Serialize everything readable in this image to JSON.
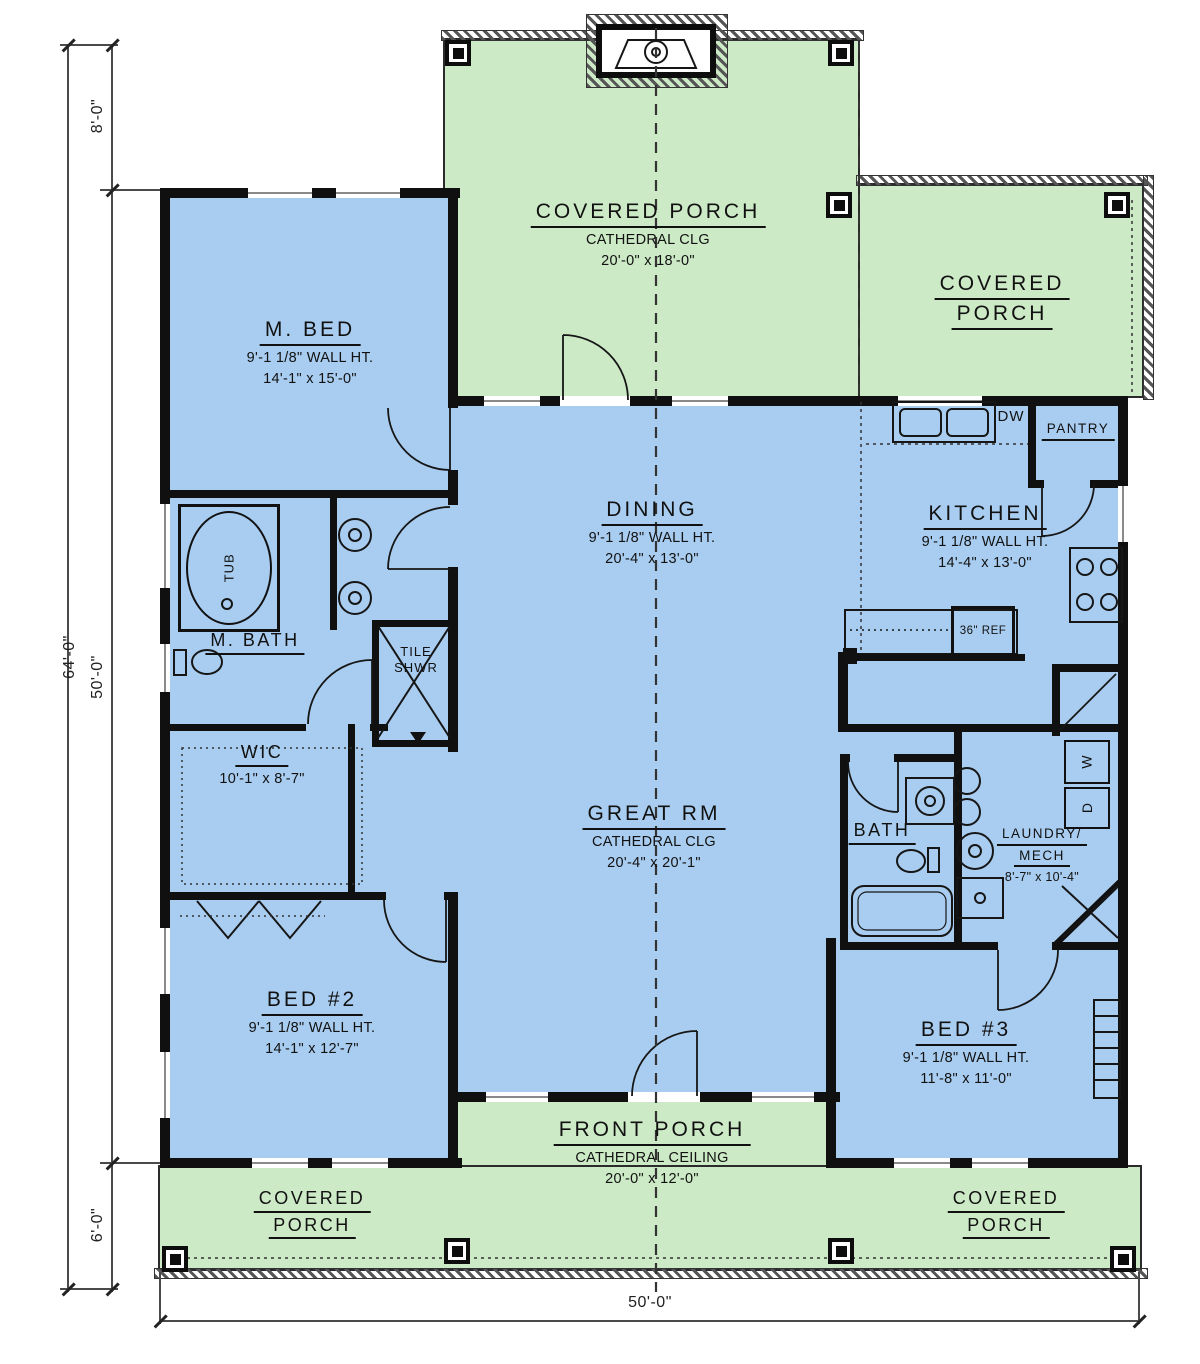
{
  "title": "Single-level house floor plan",
  "colors": {
    "porch_green": "#cdeac6",
    "interior_blue": "#a9cdf0",
    "wall": "#101010"
  },
  "dimensions": {
    "total_height": "64'-0\"",
    "upper_offset": "8'-0\"",
    "main_height": "50'-0\"",
    "lower_offset": "6'-0\"",
    "total_width": "50'-0\""
  },
  "rooms": {
    "porch_top": {
      "title": "COVERED PORCH",
      "line2": "CATHEDRAL CLG",
      "line3": "20'-0\" x 18'-0\""
    },
    "porch_right": {
      "title1": "COVERED",
      "title2": "PORCH"
    },
    "m_bed": {
      "title": "M. BED",
      "line2": "9'-1 1/8\" WALL HT.",
      "line3": "14'-1\" x 15'-0\""
    },
    "dining": {
      "title": "DINING",
      "line2": "9'-1 1/8\" WALL HT.",
      "line3": "20'-4\" x 13'-0\""
    },
    "kitchen": {
      "title": "KITCHEN",
      "line2": "9'-1 1/8\" WALL HT.",
      "line3": "14'-4\" x 13'-0\""
    },
    "m_bath": {
      "title": "M. BATH"
    },
    "wic": {
      "title": "WIC",
      "line3": "10'-1\" x 8'-7\""
    },
    "great_rm": {
      "title": "GREAT RM",
      "line2": "CATHEDRAL CLG",
      "line3": "20'-4\" x 20'-1\""
    },
    "bath": {
      "title": "BATH"
    },
    "laundry": {
      "title1": "LAUNDRY/",
      "title2": "MECH",
      "line3": "8'-7\" x 10'-4\""
    },
    "bed2": {
      "title": "BED #2",
      "line2": "9'-1 1/8\" WALL HT.",
      "line3": "14'-1\" x 12'-7\""
    },
    "bed3": {
      "title": "BED #3",
      "line2": "9'-1 1/8\" WALL HT.",
      "line3": "11'-8\" x 11'-0\""
    },
    "front_porch": {
      "title": "FRONT PORCH",
      "line2": "CATHEDRAL CEILING",
      "line3": "20'-0\" x 12'-0\""
    },
    "porch_bl": {
      "title1": "COVERED",
      "title2": "PORCH"
    },
    "porch_br": {
      "title1": "COVERED",
      "title2": "PORCH"
    },
    "pantry": {
      "title": "PANTRY"
    }
  },
  "fixtures": {
    "dw": "DW",
    "ref": "36\" REF",
    "washer": "W",
    "dryer": "D",
    "tub": "TUB",
    "shower1": "TILE",
    "shower2": "SHWR"
  }
}
